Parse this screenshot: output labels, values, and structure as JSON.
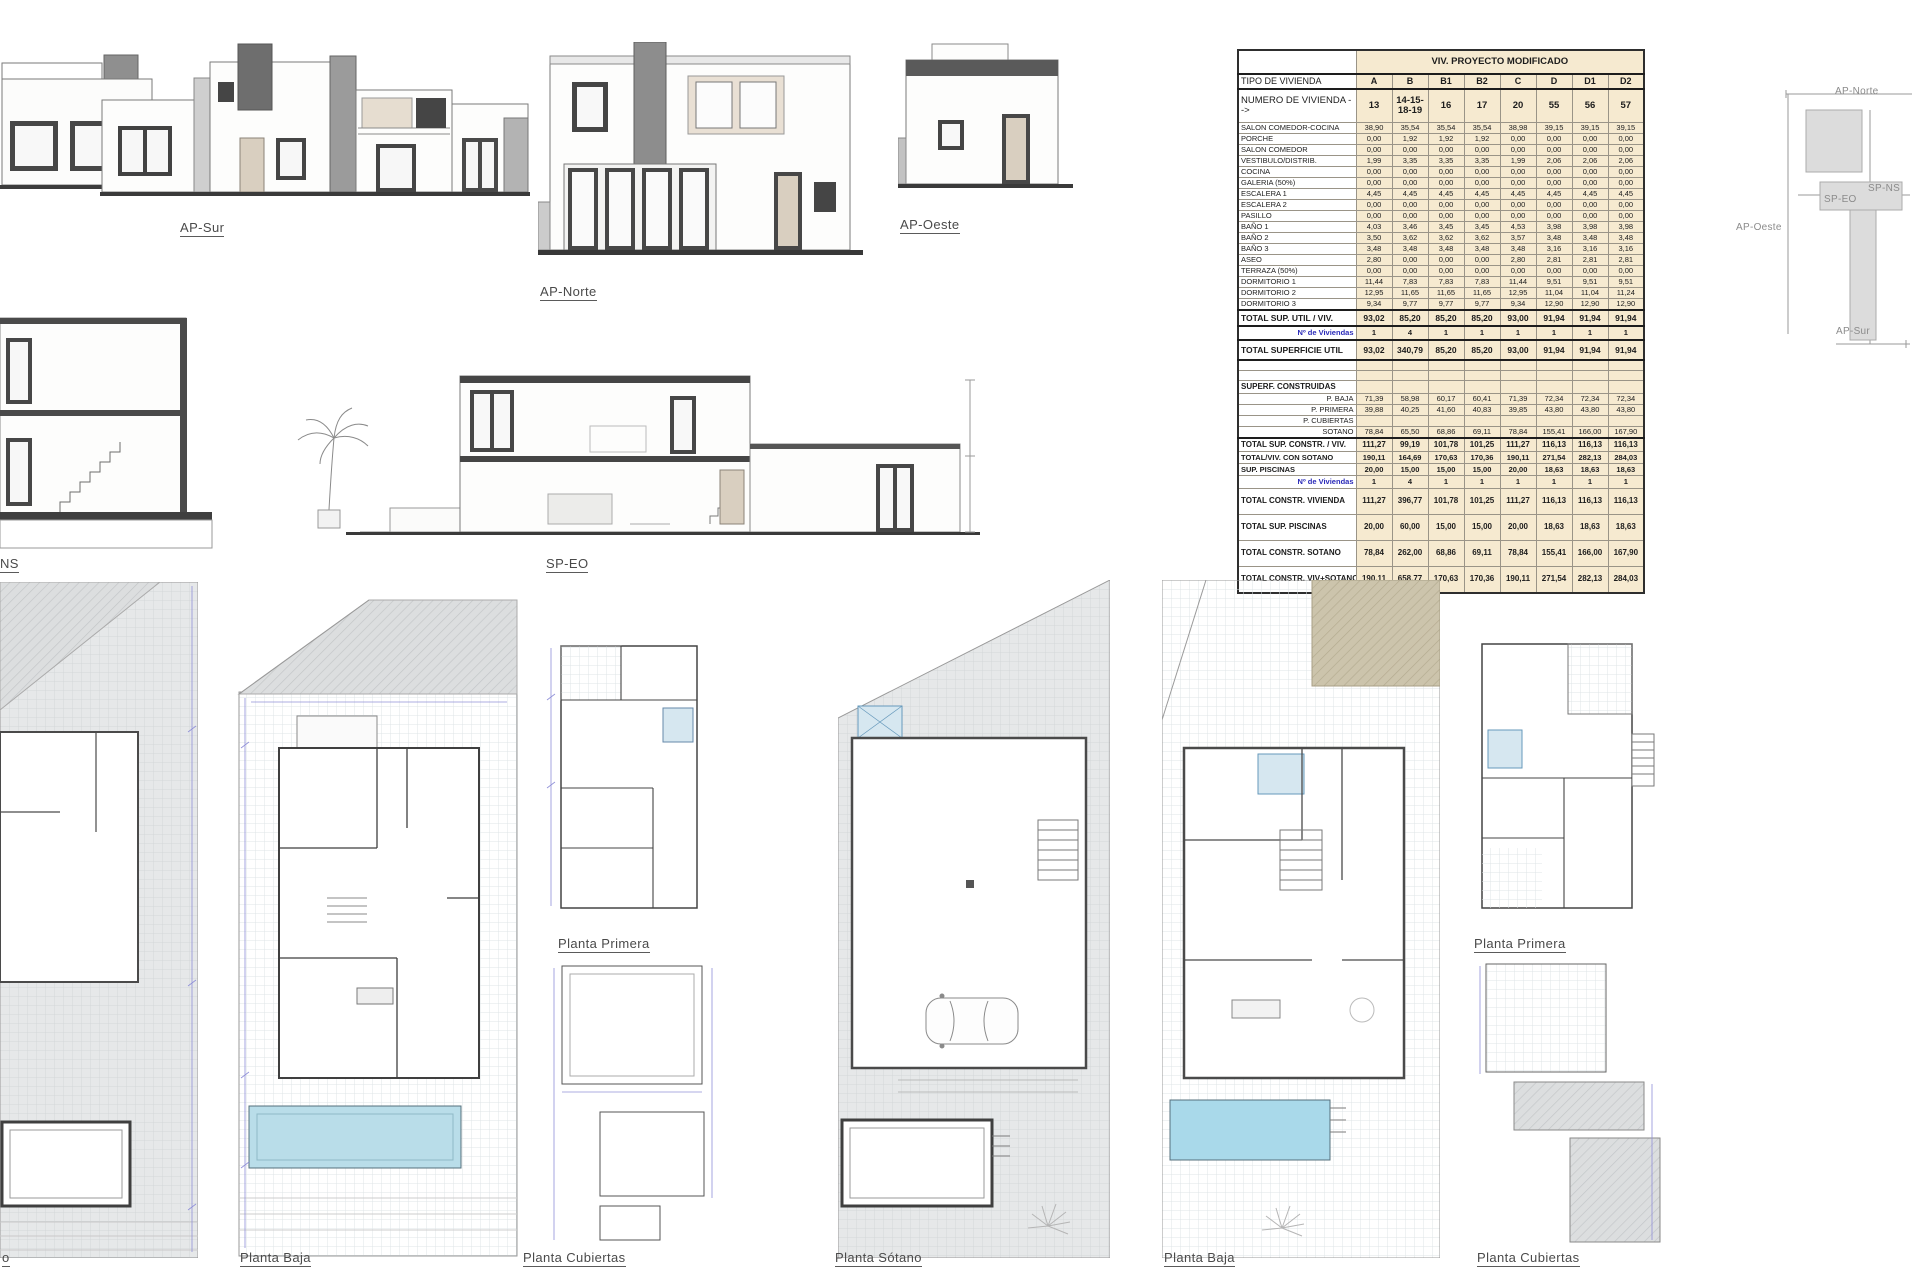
{
  "labels": {
    "ap_sur": "AP-Sur",
    "ap_norte": "AP-Norte",
    "ap_oeste": "AP-Oeste",
    "sp_eo": "SP-EO",
    "sp_ns_truncated": "NS",
    "plan_sotano_left_truncated": "o",
    "planta_baja_left": "Planta Baja",
    "planta_primera_left": "Planta Primera",
    "planta_cubiertas_left": "Planta Cubiertas",
    "planta_sotano_right": "Planta Sótano",
    "planta_baja_right": "Planta Baja",
    "planta_primera_right": "Planta Primera",
    "planta_cubiertas_right": "Planta Cubiertas"
  },
  "key_plan": {
    "ap_norte": "AP-Norte",
    "ap_oeste": "AP-Oeste",
    "ap_sur": "AP-Sur",
    "sp_ns": "SP-NS",
    "sp_eo": "SP-EO"
  },
  "table": {
    "title": "VIV. PROYECTO MODIFICADO",
    "tipo_label": "TIPO DE VIVIENDA",
    "tipos": [
      "A",
      "B",
      "B1",
      "B2",
      "C",
      "D",
      "D1",
      "D2"
    ],
    "numero_label": "NUMERO DE VIVIENDA -->",
    "numeros": [
      "13",
      "14-15-18-19",
      "16",
      "17",
      "20",
      "55",
      "56",
      "57"
    ],
    "rows": [
      {
        "label": "SALON COMEDOR-COCINA",
        "values": [
          "38,90",
          "35,54",
          "35,54",
          "35,54",
          "38,98",
          "39,15",
          "39,15",
          "39,15"
        ]
      },
      {
        "label": "PORCHE",
        "values": [
          "0,00",
          "1,92",
          "1,92",
          "1,92",
          "0,00",
          "0,00",
          "0,00",
          "0,00"
        ]
      },
      {
        "label": "SALON COMEDOR",
        "values": [
          "0,00",
          "0,00",
          "0,00",
          "0,00",
          "0,00",
          "0,00",
          "0,00",
          "0,00"
        ]
      },
      {
        "label": "VESTIBULO/DISTRIB.",
        "values": [
          "1,99",
          "3,35",
          "3,35",
          "3,35",
          "1,99",
          "2,06",
          "2,06",
          "2,06"
        ]
      },
      {
        "label": "COCINA",
        "values": [
          "0,00",
          "0,00",
          "0,00",
          "0,00",
          "0,00",
          "0,00",
          "0,00",
          "0,00"
        ]
      },
      {
        "label": "GALERIA (50%)",
        "values": [
          "0,00",
          "0,00",
          "0,00",
          "0,00",
          "0,00",
          "0,00",
          "0,00",
          "0,00"
        ]
      },
      {
        "label": "ESCALERA 1",
        "values": [
          "4,45",
          "4,45",
          "4,45",
          "4,45",
          "4,45",
          "4,45",
          "4,45",
          "4,45"
        ]
      },
      {
        "label": "ESCALERA 2",
        "values": [
          "0,00",
          "0,00",
          "0,00",
          "0,00",
          "0,00",
          "0,00",
          "0,00",
          "0,00"
        ]
      },
      {
        "label": "PASILLO",
        "values": [
          "0,00",
          "0,00",
          "0,00",
          "0,00",
          "0,00",
          "0,00",
          "0,00",
          "0,00"
        ]
      },
      {
        "label": "BAÑO 1",
        "values": [
          "4,03",
          "3,46",
          "3,45",
          "3,45",
          "4,53",
          "3,98",
          "3,98",
          "3,98"
        ]
      },
      {
        "label": "BAÑO 2",
        "values": [
          "3,50",
          "3,62",
          "3,62",
          "3,62",
          "3,57",
          "3,48",
          "3,48",
          "3,48"
        ]
      },
      {
        "label": "BAÑO 3",
        "values": [
          "3,48",
          "3,48",
          "3,48",
          "3,48",
          "3,48",
          "3,16",
          "3,16",
          "3,16"
        ]
      },
      {
        "label": "ASEO",
        "values": [
          "2,80",
          "0,00",
          "0,00",
          "0,00",
          "2,80",
          "2,81",
          "2,81",
          "2,81"
        ]
      },
      {
        "label": "TERRAZA (50%)",
        "values": [
          "0,00",
          "0,00",
          "0,00",
          "0,00",
          "0,00",
          "0,00",
          "0,00",
          "0,00"
        ]
      },
      {
        "label": "DORMITORIO 1",
        "values": [
          "11,44",
          "7,83",
          "7,83",
          "7,83",
          "11,44",
          "9,51",
          "9,51",
          "9,51"
        ]
      },
      {
        "label": "DORMITORIO 2",
        "values": [
          "12,95",
          "11,65",
          "11,65",
          "11,65",
          "12,95",
          "11,04",
          "11,04",
          "11,24"
        ]
      },
      {
        "label": "DORMITORIO 3",
        "values": [
          "9,34",
          "9,77",
          "9,77",
          "9,77",
          "9,34",
          "12,90",
          "12,90",
          "12,90"
        ]
      }
    ],
    "total_util_viv": {
      "label": "TOTAL SUP. UTIL / VIV.",
      "values": [
        "93,02",
        "85,20",
        "85,20",
        "85,20",
        "93,00",
        "91,94",
        "91,94",
        "91,94"
      ]
    },
    "n_viviendas_label": "Nº de Viviendas",
    "n_viviendas_1": [
      "1",
      "4",
      "1",
      "1",
      "1",
      "1",
      "1",
      "1"
    ],
    "total_superficie_util": {
      "label": "TOTAL SUPERFICIE UTIL",
      "values": [
        "93,02",
        "340,79",
        "85,20",
        "85,20",
        "93,00",
        "91,94",
        "91,94",
        "91,94"
      ]
    },
    "superf_construidas_label": "SUPERF. CONSTRUIDAS",
    "construidas_rows": [
      {
        "label": "P. BAJA",
        "values": [
          "71,39",
          "58,98",
          "60,17",
          "60,41",
          "71,39",
          "72,34",
          "72,34",
          "72,34"
        ]
      },
      {
        "label": "P. PRIMERA",
        "values": [
          "39,88",
          "40,25",
          "41,60",
          "40,83",
          "39,85",
          "43,80",
          "43,80",
          "43,80"
        ]
      },
      {
        "label": "P. CUBIERTAS",
        "values": [
          "",
          "",
          "",
          "",
          "",
          "",
          "",
          ""
        ]
      },
      {
        "label": "SOTANO",
        "values": [
          "78,84",
          "65,50",
          "68,86",
          "69,11",
          "78,84",
          "155,41",
          "166,00",
          "167,90"
        ]
      }
    ],
    "total_constr_viv": {
      "label": "TOTAL SUP. CONSTR. / VIV.",
      "values": [
        "111,27",
        "99,19",
        "101,78",
        "101,25",
        "111,27",
        "116,13",
        "116,13",
        "116,13"
      ]
    },
    "total_viv_con_sotano": {
      "label": "TOTAL/VIV. CON SOTANO",
      "values": [
        "190,11",
        "164,69",
        "170,63",
        "170,36",
        "190,11",
        "271,54",
        "282,13",
        "284,03"
      ]
    },
    "sup_piscinas": {
      "label": "SUP. PISCINAS",
      "values": [
        "20,00",
        "15,00",
        "15,00",
        "15,00",
        "20,00",
        "18,63",
        "18,63",
        "18,63"
      ]
    },
    "n_viviendas_2": [
      "1",
      "4",
      "1",
      "1",
      "1",
      "1",
      "1",
      "1"
    ],
    "grand_rows": [
      {
        "label": "TOTAL CONSTR. VIVIENDA",
        "values": [
          "111,27",
          "396,77",
          "101,78",
          "101,25",
          "111,27",
          "116,13",
          "116,13",
          "116,13"
        ]
      },
      {
        "label": "TOTAL SUP. PISCINAS",
        "values": [
          "20,00",
          "60,00",
          "15,00",
          "15,00",
          "20,00",
          "18,63",
          "18,63",
          "18,63"
        ]
      },
      {
        "label": "TOTAL CONSTR. SOTANO",
        "values": [
          "78,84",
          "262,00",
          "68,86",
          "69,11",
          "78,84",
          "155,41",
          "166,00",
          "167,90"
        ]
      },
      {
        "label": "TOTAL CONSTR. VIV+SOTANO",
        "values": [
          "190,11",
          "658,77",
          "170,63",
          "170,36",
          "190,11",
          "271,54",
          "282,13",
          "284,03"
        ]
      }
    ],
    "colors": {
      "cell_bg": "#f6ead0",
      "label_bg": "#ffffff",
      "n_viviendas_text": "#2a2ab8"
    }
  }
}
